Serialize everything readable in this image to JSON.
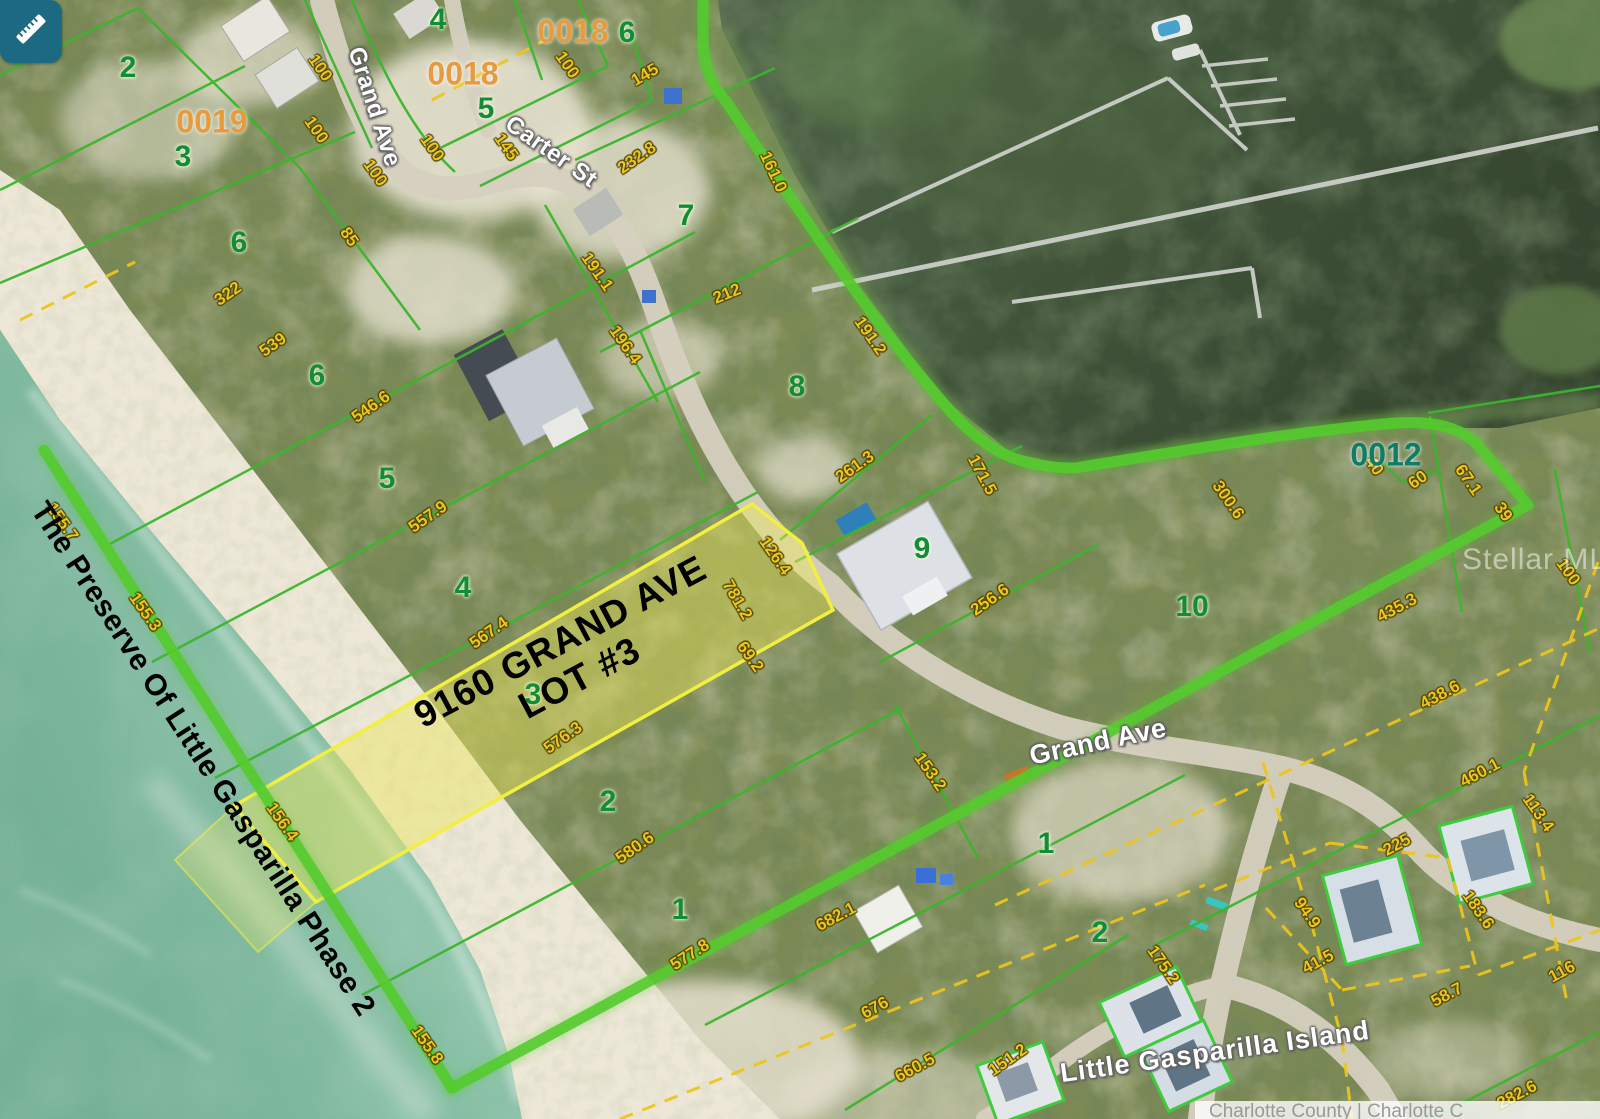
{
  "map": {
    "tool_button": {
      "icon": "ruler-icon"
    },
    "watermark": "Stellar MLS",
    "attribution": "Charlotte County | Charlotte C",
    "subject": {
      "line1": "9160 GRAND AVE",
      "line2": "LOT #3"
    },
    "plat_name": "The Preserve Of Little Gasparilla Phase 2",
    "island_name": "Little Gasparilla Island",
    "colors": {
      "highlight_path_green": "#54cb2d",
      "parcel_line_green": "#3cb52c",
      "dimension_yellow": "#eac61e",
      "subject_lot_fill": "rgba(238,230,90,0.45)",
      "subject_lot_stroke": "#f2ef3f",
      "tool_teal": "#1c6a82",
      "parcel_id_orange": "#e79b3c",
      "parcel_id_teal": "#0e7d68"
    },
    "streets": [
      {
        "text": "Grand Ave",
        "x": 374,
        "y": 107,
        "rot": 72,
        "size": 24
      },
      {
        "text": "Carter St",
        "x": 551,
        "y": 152,
        "rot": 35,
        "size": 24
      },
      {
        "text": "Grand Ave",
        "x": 1098,
        "y": 742,
        "rot": -12,
        "size": 27
      }
    ],
    "parcel_ids": [
      {
        "text": "0019",
        "x": 212,
        "y": 122,
        "color": "#e79b3c"
      },
      {
        "text": "0018",
        "x": 463,
        "y": 74,
        "color": "#e79b3c"
      },
      {
        "text": "0018",
        "x": 573,
        "y": 32,
        "color": "#e79b3c"
      },
      {
        "text": "0012",
        "x": 1386,
        "y": 455,
        "color": "#0e7d68"
      }
    ],
    "lot_numbers": [
      {
        "text": "2",
        "x": 128,
        "y": 68
      },
      {
        "text": "3",
        "x": 183,
        "y": 157
      },
      {
        "text": "6",
        "x": 239,
        "y": 243
      },
      {
        "text": "6",
        "x": 317,
        "y": 376
      },
      {
        "text": "5",
        "x": 387,
        "y": 479
      },
      {
        "text": "4",
        "x": 463,
        "y": 588
      },
      {
        "text": "3",
        "x": 533,
        "y": 695
      },
      {
        "text": "2",
        "x": 608,
        "y": 802
      },
      {
        "text": "1",
        "x": 680,
        "y": 910
      },
      {
        "text": "4",
        "x": 438,
        "y": 20
      },
      {
        "text": "5",
        "x": 486,
        "y": 109
      },
      {
        "text": "6",
        "x": 627,
        "y": 33
      },
      {
        "text": "7",
        "x": 686,
        "y": 216
      },
      {
        "text": "8",
        "x": 797,
        "y": 387
      },
      {
        "text": "9",
        "x": 922,
        "y": 549
      },
      {
        "text": "10",
        "x": 1192,
        "y": 607
      },
      {
        "text": "1",
        "x": 1046,
        "y": 844
      },
      {
        "text": "2",
        "x": 1100,
        "y": 933
      }
    ],
    "dimensions": [
      {
        "text": "100",
        "x": 320,
        "y": 68,
        "rot": 55
      },
      {
        "text": "100",
        "x": 316,
        "y": 130,
        "rot": 55
      },
      {
        "text": "100",
        "x": 375,
        "y": 173,
        "rot": 55
      },
      {
        "text": "85",
        "x": 349,
        "y": 237,
        "rot": 55
      },
      {
        "text": "322",
        "x": 228,
        "y": 294,
        "rot": -35
      },
      {
        "text": "539",
        "x": 273,
        "y": 345,
        "rot": -35
      },
      {
        "text": "100",
        "x": 567,
        "y": 65,
        "rot": 55
      },
      {
        "text": "145",
        "x": 645,
        "y": 75,
        "rot": -30
      },
      {
        "text": "145",
        "x": 506,
        "y": 147,
        "rot": 55
      },
      {
        "text": "100",
        "x": 432,
        "y": 148,
        "rot": 55
      },
      {
        "text": "232.8",
        "x": 637,
        "y": 158,
        "rot": -35
      },
      {
        "text": "161.0",
        "x": 773,
        "y": 172,
        "rot": 65
      },
      {
        "text": "191.1",
        "x": 597,
        "y": 272,
        "rot": 55
      },
      {
        "text": "196.4",
        "x": 625,
        "y": 345,
        "rot": 55
      },
      {
        "text": "212",
        "x": 727,
        "y": 294,
        "rot": -22
      },
      {
        "text": "191.2",
        "x": 870,
        "y": 336,
        "rot": 55
      },
      {
        "text": "261.3",
        "x": 855,
        "y": 467,
        "rot": -35
      },
      {
        "text": "171.5",
        "x": 982,
        "y": 475,
        "rot": 62
      },
      {
        "text": "256.6",
        "x": 990,
        "y": 600,
        "rot": -35
      },
      {
        "text": "300.6",
        "x": 1228,
        "y": 500,
        "rot": 55
      },
      {
        "text": "40",
        "x": 1374,
        "y": 466,
        "rot": 55
      },
      {
        "text": "60",
        "x": 1418,
        "y": 480,
        "rot": -35
      },
      {
        "text": "67.1",
        "x": 1468,
        "y": 480,
        "rot": 55
      },
      {
        "text": "39",
        "x": 1503,
        "y": 512,
        "rot": 55
      },
      {
        "text": "435.3",
        "x": 1397,
        "y": 608,
        "rot": -28
      },
      {
        "text": "100",
        "x": 1568,
        "y": 572,
        "rot": 55
      },
      {
        "text": "546.6",
        "x": 371,
        "y": 407,
        "rot": -35
      },
      {
        "text": "557.9",
        "x": 428,
        "y": 517,
        "rot": -35
      },
      {
        "text": "567.4",
        "x": 489,
        "y": 633,
        "rot": -35
      },
      {
        "text": "576.3",
        "x": 563,
        "y": 738,
        "rot": -35
      },
      {
        "text": "580.6",
        "x": 635,
        "y": 848,
        "rot": -35
      },
      {
        "text": "577.8",
        "x": 690,
        "y": 955,
        "rot": -33
      },
      {
        "text": "126.4",
        "x": 775,
        "y": 556,
        "rot": 55
      },
      {
        "text": "781.2",
        "x": 737,
        "y": 600,
        "rot": 60
      },
      {
        "text": "69.2",
        "x": 750,
        "y": 657,
        "rot": 55
      },
      {
        "text": "153.2",
        "x": 930,
        "y": 772,
        "rot": 55
      },
      {
        "text": "155.7",
        "x": 62,
        "y": 522,
        "rot": 55
      },
      {
        "text": "155.3",
        "x": 145,
        "y": 612,
        "rot": 55
      },
      {
        "text": "156.4",
        "x": 282,
        "y": 822,
        "rot": 55
      },
      {
        "text": "155.8",
        "x": 427,
        "y": 1045,
        "rot": 55
      },
      {
        "text": "682.1",
        "x": 836,
        "y": 917,
        "rot": -28
      },
      {
        "text": "676",
        "x": 875,
        "y": 1008,
        "rot": -28
      },
      {
        "text": "660.5",
        "x": 915,
        "y": 1068,
        "rot": -28
      },
      {
        "text": "151.2",
        "x": 1008,
        "y": 1060,
        "rot": -35
      },
      {
        "text": "175.2",
        "x": 1163,
        "y": 965,
        "rot": 55
      },
      {
        "text": "438.6",
        "x": 1440,
        "y": 695,
        "rot": -28
      },
      {
        "text": "460.1",
        "x": 1480,
        "y": 773,
        "rot": -28
      },
      {
        "text": "113.4",
        "x": 1538,
        "y": 813,
        "rot": 55
      },
      {
        "text": "225",
        "x": 1397,
        "y": 845,
        "rot": -28
      },
      {
        "text": "94.9",
        "x": 1307,
        "y": 913,
        "rot": 55
      },
      {
        "text": "41.5",
        "x": 1318,
        "y": 962,
        "rot": -28
      },
      {
        "text": "183.6",
        "x": 1478,
        "y": 910,
        "rot": 55
      },
      {
        "text": "58.7",
        "x": 1447,
        "y": 995,
        "rot": -28
      },
      {
        "text": "116",
        "x": 1562,
        "y": 972,
        "rot": -28
      },
      {
        "text": "282.6",
        "x": 1517,
        "y": 1095,
        "rot": -28
      }
    ]
  }
}
